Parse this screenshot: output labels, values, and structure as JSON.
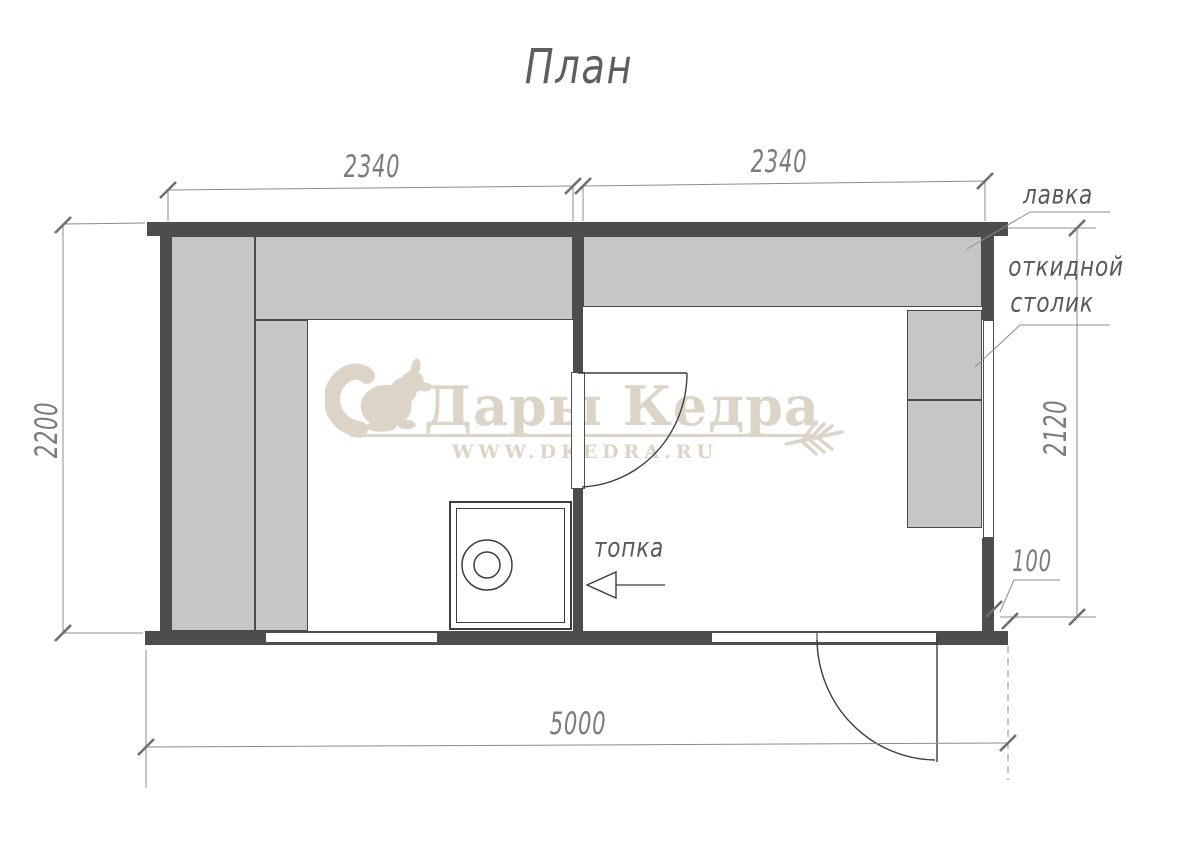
{
  "title": "План",
  "watermark": {
    "brand": "Дары Кедра",
    "url": "WWW.DKEDRA.RU",
    "color": "#dcd4c7",
    "icons": [
      "squirrel-icon",
      "wheat-icon"
    ]
  },
  "dimensions": {
    "top_left_mm": "2340",
    "top_right_mm": "2340",
    "left_height_mm": "2200",
    "right_height_mm": "2120",
    "wall_offset_mm": "100",
    "bottom_width_mm": "5000"
  },
  "labels": {
    "bench": "лавка",
    "folding_table_line1": "откидной",
    "folding_table_line2": "столик",
    "firebox": "топка"
  },
  "colors": {
    "wall": "#4d4d4d",
    "bench_fill": "#c6c6c6",
    "dimension_line": "#8c8c8c",
    "dimension_text": "#7c7c7c",
    "label_text": "#58585a",
    "watermark": "#dcd4c7"
  }
}
